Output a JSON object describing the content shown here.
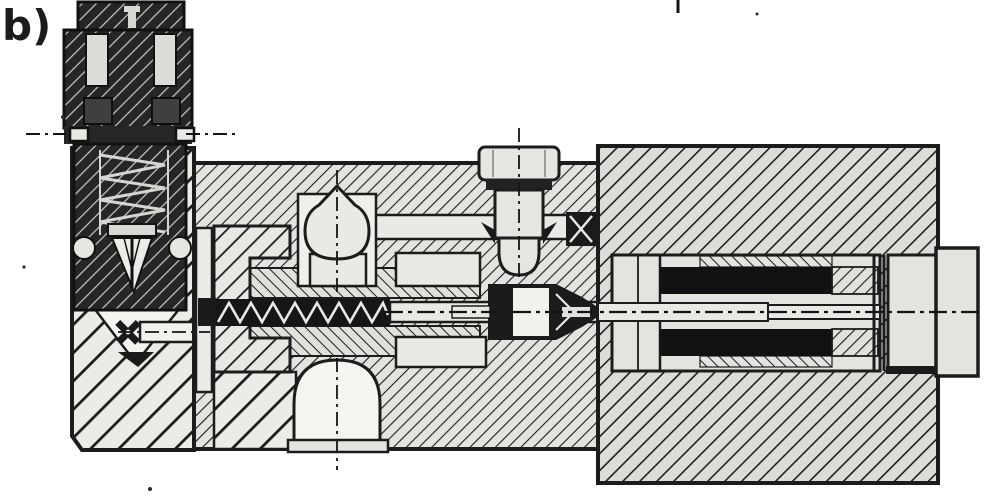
{
  "figure": {
    "label": "b)",
    "type": "engineering-cross-section-drawing",
    "colors": {
      "ink": "#1c1c1c",
      "paper": "#ffffff",
      "part_light": "#e9e9e5",
      "block_mid": "#e3e3df",
      "block_right": "#dcdcd8",
      "block_left": "#ebebe7",
      "dark_part": "#262626",
      "black_fill": "#141414"
    }
  }
}
